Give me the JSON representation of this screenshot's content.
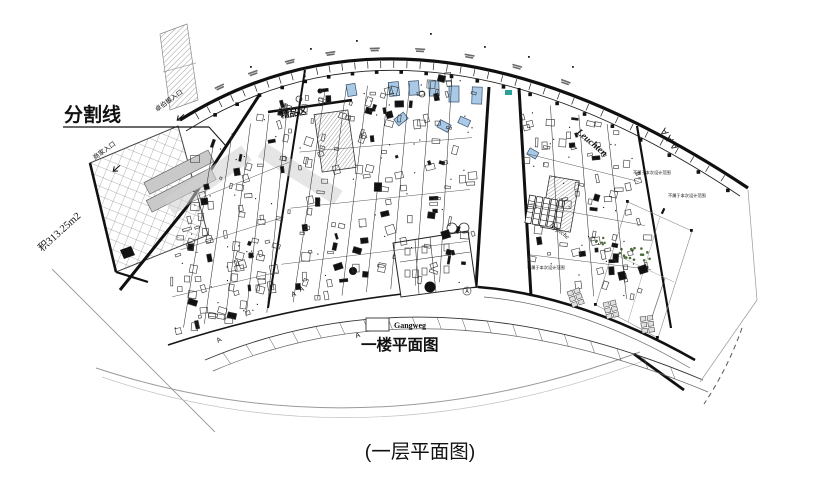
{
  "page": {
    "background": "#ffffff",
    "caption": "(一层平面图)"
  },
  "plan": {
    "floor_title": "一楼平面图",
    "legend_label": "Gangweg",
    "divider_label": "分割线",
    "area_label": "积313.25m2",
    "merchant_entrance_label": "商家入口",
    "brand_entrance_label": "卓伯根入口",
    "boutique_label": "精品区",
    "leuchten_label": "Leuchten",
    "teppiche_label": "Teppiche",
    "aaa_label": "AAA",
    "scope_note": "不属于本次设计范围",
    "grid_letter": "A",
    "colors": {
      "line": "#1b1b1b",
      "glass": "#a9c9e6",
      "teal": "#2aa198",
      "green": "#4c6b38",
      "gray": "#9a9a9a"
    }
  }
}
